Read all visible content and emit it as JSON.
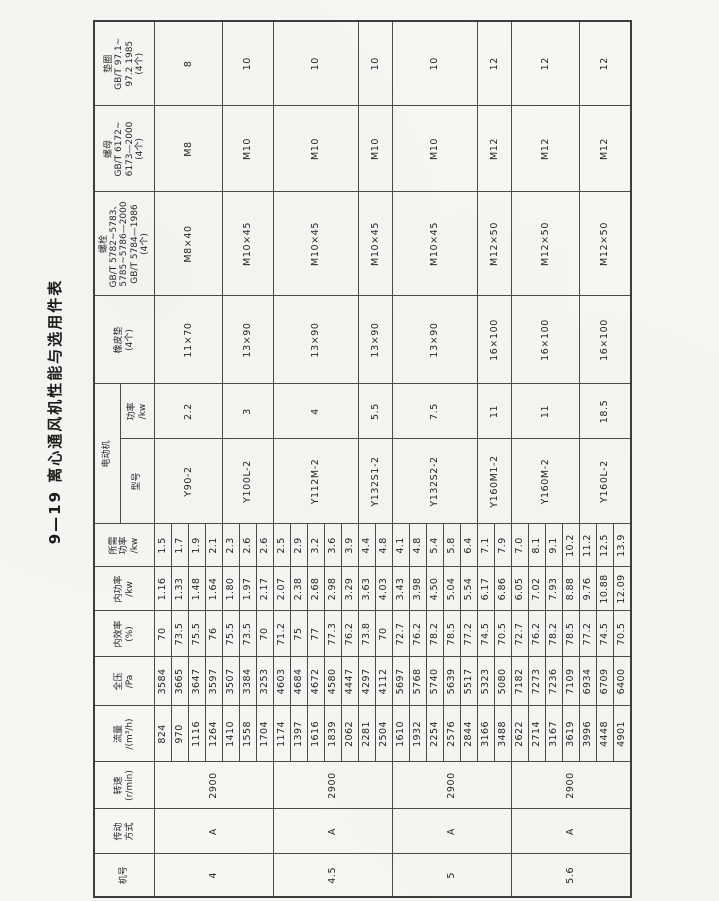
{
  "title": "9—19  离心通风机性能与选用件表",
  "table": {
    "headers": {
      "jihao": "机号",
      "chuandong": "传动\n方式",
      "zhuansu": "转速\n(r/min)",
      "liuliang": "流量\n/(m³/h)",
      "quanya": "全压\n/Pa",
      "neixiaolv": "内效率\n(%)",
      "neigonglv": "内功率\n/kw",
      "suoxugonglv": "所需\n功率\n/kw",
      "diandongji": "电动机",
      "xinghao": "型号",
      "gonglv": "功率\n/kw",
      "xiangpidian": "橡皮垫\n(4个)",
      "luoshuan": "螺栓\nGB/T 5782~5783、\n5785~5786—2000\nGB/T 5784—1986\n(4个)",
      "luomu": "螺母\nGB/T 6172~\n6173—2000\n(4个)",
      "dianquan": "垫圈\nGB/T 97.1~\n97.2 1985\n(4个)"
    },
    "row_columns": [
      "流量/(m³/h)",
      "全压/Pa",
      "内效率(%)",
      "内功率/kw",
      "所需功率/kw"
    ],
    "groups": [
      {
        "jihao": "4",
        "chuandong": "A",
        "zhuansu": "2900",
        "rows": [
          [
            "824",
            "3584",
            "70",
            "1.16",
            "1.5"
          ],
          [
            "970",
            "3665",
            "73.5",
            "1.33",
            "1.7"
          ],
          [
            "1116",
            "3647",
            "75.5",
            "1.48",
            "1.9"
          ],
          [
            "1264",
            "3597",
            "76",
            "1.64",
            "2.1"
          ],
          [
            "1410",
            "3507",
            "75.5",
            "1.80",
            "2.3"
          ],
          [
            "1558",
            "3384",
            "73.5",
            "1.97",
            "2.6"
          ],
          [
            "1704",
            "3253",
            "70",
            "2.17",
            "2.6"
          ]
        ]
      },
      {
        "jihao": "4.5",
        "chuandong": "A",
        "zhuansu": "2900",
        "rows": [
          [
            "1174",
            "4603",
            "71.2",
            "2.07",
            "2.5"
          ],
          [
            "1397",
            "4684",
            "75",
            "2.38",
            "2.9"
          ],
          [
            "1616",
            "4672",
            "77",
            "2.68",
            "3.2"
          ],
          [
            "1839",
            "4580",
            "77.3",
            "2.98",
            "3.6"
          ],
          [
            "2062",
            "4447",
            "76.2",
            "3.29",
            "3.9"
          ],
          [
            "2281",
            "4297",
            "73.8",
            "3.63",
            "4.4"
          ],
          [
            "2504",
            "4112",
            "70",
            "4.03",
            "4.8"
          ]
        ]
      },
      {
        "jihao": "5",
        "chuandong": "A",
        "zhuansu": "2900",
        "rows": [
          [
            "1610",
            "5697",
            "72.7",
            "3.43",
            "4.1"
          ],
          [
            "1932",
            "5768",
            "76.2",
            "3.98",
            "4.8"
          ],
          [
            "2254",
            "5740",
            "78.2",
            "4.50",
            "5.4"
          ],
          [
            "2576",
            "5639",
            "78.5",
            "5.04",
            "5.8"
          ],
          [
            "2844",
            "5517",
            "77.2",
            "5.54",
            "6.4"
          ],
          [
            "3166",
            "5323",
            "74.5",
            "6.17",
            "7.1"
          ],
          [
            "3488",
            "5080",
            "70.5",
            "6.86",
            "7.9"
          ]
        ]
      },
      {
        "jihao": "5.6",
        "chuandong": "A",
        "zhuansu": "2900",
        "rows": [
          [
            "2622",
            "7182",
            "72.7",
            "6.05",
            "7.0"
          ],
          [
            "2714",
            "7273",
            "76.2",
            "7.02",
            "8.1"
          ],
          [
            "3167",
            "7236",
            "78.2",
            "7.93",
            "9.1"
          ],
          [
            "3619",
            "7109",
            "78.5",
            "8.88",
            "10.2"
          ],
          [
            "3996",
            "6934",
            "77.2",
            "9.76",
            "11.2"
          ],
          [
            "4448",
            "6709",
            "74.5",
            "10.88",
            "12.5"
          ],
          [
            "4901",
            "6400",
            "70.5",
            "12.09",
            "13.9"
          ]
        ]
      }
    ],
    "motor_groups": [
      {
        "rows": 4,
        "xinghao": "Y90-2",
        "gonglv": "2.2",
        "xiangpidian": "11×70",
        "luoshuan": "M8×40",
        "luomu": "M8",
        "dianquan": "8"
      },
      {
        "rows": 3,
        "xinghao": "Y100L-2",
        "gonglv": "3",
        "xiangpidian": "13×90",
        "luoshuan": "M10×45",
        "luomu": "M10",
        "dianquan": "10"
      },
      {
        "rows": 5,
        "xinghao": "Y112M-2",
        "gonglv": "4",
        "xiangpidian": "13×90",
        "luoshuan": "M10×45",
        "luomu": "M10",
        "dianquan": "10"
      },
      {
        "rows": 2,
        "xinghao": "Y132S1-2",
        "gonglv": "5.5",
        "xiangpidian": "13×90",
        "luoshuan": "M10×45",
        "luomu": "M10",
        "dianquan": "10"
      },
      {
        "rows": 5,
        "xinghao": "Y132S2-2",
        "gonglv": "7.5",
        "xiangpidian": "13×90",
        "luoshuan": "M10×45",
        "luomu": "M10",
        "dianquan": "10"
      },
      {
        "rows": 2,
        "xinghao": "Y160M1-2",
        "gonglv": "11",
        "xiangpidian": "16×100",
        "luoshuan": "M12×50",
        "luomu": "M12",
        "dianquan": "12"
      },
      {
        "rows": 4,
        "xinghao": "Y160M-2",
        "gonglv": "11",
        "xiangpidian": "16×100",
        "luoshuan": "M12×50",
        "luomu": "M12",
        "dianquan": "12"
      },
      {
        "rows": 3,
        "xinghao": "Y160L-2",
        "gonglv": "18.5",
        "xiangpidian": "16×100",
        "luoshuan": "M12×50",
        "luomu": "M12",
        "dianquan": "12"
      }
    ]
  }
}
